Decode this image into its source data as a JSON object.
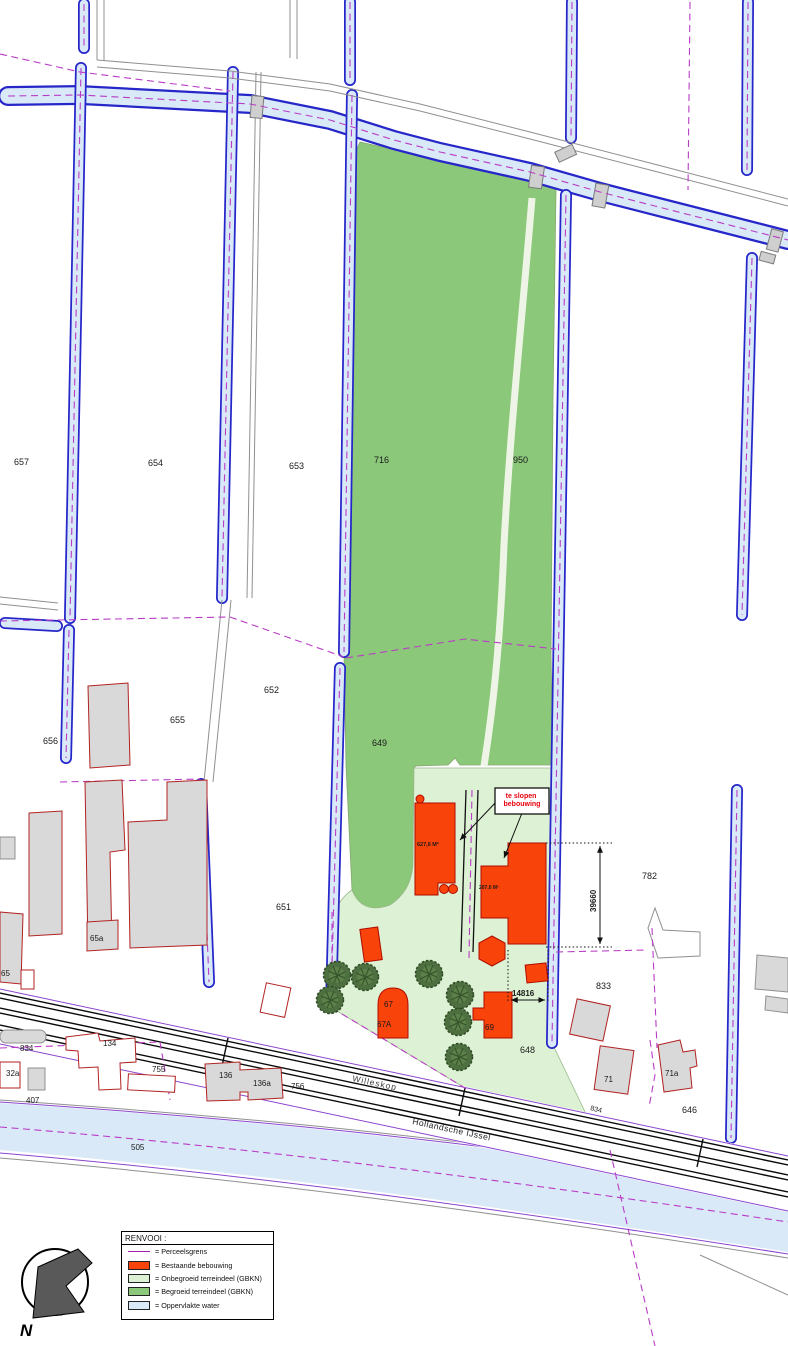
{
  "colors": {
    "water_fill": "#d9e9f8",
    "water_edge": "#2626c9",
    "parcel_line": "#b93cc6",
    "vegetated_green": "#8cc87a",
    "open_terrain_green": "#ddf2d5",
    "building_red": "#f8430a",
    "gray_building": "#d9d9d9",
    "road_black": "#0a0a0a"
  },
  "legend": {
    "title": "RENVOOI :",
    "items": [
      {
        "symbol": "line",
        "color": "#a21caf",
        "label": "= Perceelsgrens"
      },
      {
        "symbol": "swatch",
        "color": "#f8430a",
        "label": "= Bestaande bebouwing"
      },
      {
        "symbol": "swatch",
        "color": "#ddf2d5",
        "label": "= Onbegroeid terreindeel (GBKN)"
      },
      {
        "symbol": "swatch",
        "color": "#8cc87a",
        "label": "= Begroeid terreindeel (GBKN)"
      },
      {
        "symbol": "swatch",
        "color": "#d9e9f8",
        "label": "= Oppervlakte water"
      }
    ]
  },
  "annotation": {
    "line1": "te slopen",
    "line2": "bebouwing",
    "color": "#e8000d"
  },
  "compass": {
    "label": "N"
  },
  "map": {
    "labels": [
      {
        "t": "657",
        "x": 14,
        "y": 465
      },
      {
        "t": "654",
        "x": 148,
        "y": 466
      },
      {
        "t": "653",
        "x": 289,
        "y": 469
      },
      {
        "t": "716",
        "x": 374,
        "y": 463
      },
      {
        "t": "950",
        "x": 513,
        "y": 463
      },
      {
        "t": "652",
        "x": 264,
        "y": 693
      },
      {
        "t": "655",
        "x": 170,
        "y": 723
      },
      {
        "t": "656",
        "x": 43,
        "y": 744
      },
      {
        "t": "649",
        "x": 372,
        "y": 746
      },
      {
        "t": "651",
        "x": 276,
        "y": 910
      },
      {
        "t": "65a",
        "x": 90,
        "y": 941,
        "s": 8
      },
      {
        "t": "65",
        "x": 1,
        "y": 976,
        "s": 8
      },
      {
        "t": "782",
        "x": 642,
        "y": 879
      },
      {
        "t": "833",
        "x": 596,
        "y": 989
      },
      {
        "t": "648",
        "x": 520,
        "y": 1053
      },
      {
        "t": "646",
        "x": 682,
        "y": 1113
      },
      {
        "t": "834",
        "x": 20,
        "y": 1051,
        "s": 8
      },
      {
        "t": "32a",
        "x": 6,
        "y": 1076,
        "s": 8
      },
      {
        "t": "407",
        "x": 26,
        "y": 1103,
        "s": 8
      },
      {
        "t": "134",
        "x": 103,
        "y": 1046,
        "s": 8
      },
      {
        "t": "755",
        "x": 152,
        "y": 1072,
        "s": 8
      },
      {
        "t": "136",
        "x": 219,
        "y": 1078,
        "s": 8
      },
      {
        "t": "136a",
        "x": 253,
        "y": 1086,
        "s": 8
      },
      {
        "t": "756",
        "x": 291,
        "y": 1089,
        "s": 8
      },
      {
        "t": "505",
        "x": 131,
        "y": 1150,
        "s": 8
      },
      {
        "t": "71",
        "x": 604,
        "y": 1082,
        "s": 8
      },
      {
        "t": "71a",
        "x": 665,
        "y": 1076,
        "s": 8
      },
      {
        "t": "67",
        "x": 384,
        "y": 1007,
        "s": 8
      },
      {
        "t": "67A",
        "x": 377,
        "y": 1027,
        "s": 8
      },
      {
        "t": "69",
        "x": 485,
        "y": 1030,
        "s": 8
      },
      {
        "t": "834",
        "x": 590,
        "y": 1110,
        "s": 7,
        "r": 14
      },
      {
        "t": "627,6 M²",
        "x": 417,
        "y": 846,
        "s": 5.5,
        "w": "bold"
      },
      {
        "t": "207,6 M²",
        "x": 479,
        "y": 889,
        "s": 5,
        "w": "bold"
      },
      {
        "t": "39660",
        "x": 596,
        "y": 912,
        "s": 8,
        "w": "bold",
        "r": -90
      },
      {
        "t": "14816",
        "x": 512,
        "y": 996,
        "s": 8,
        "w": "bold"
      },
      {
        "t": "Willeskop",
        "x": 352,
        "y": 1081,
        "s": 8.5,
        "r": 12,
        "c": "#3d3d3d",
        "ls": 1
      },
      {
        "t": "Hollandsche IJssel",
        "x": 412,
        "y": 1124,
        "s": 8.5,
        "r": 12,
        "c": "#222",
        "ls": 0.5
      }
    ],
    "trees": [
      [
        337,
        975
      ],
      [
        330,
        1000
      ],
      [
        365,
        977
      ],
      [
        429,
        974
      ],
      [
        460,
        995
      ],
      [
        458,
        1022
      ],
      [
        459,
        1057
      ]
    ]
  }
}
